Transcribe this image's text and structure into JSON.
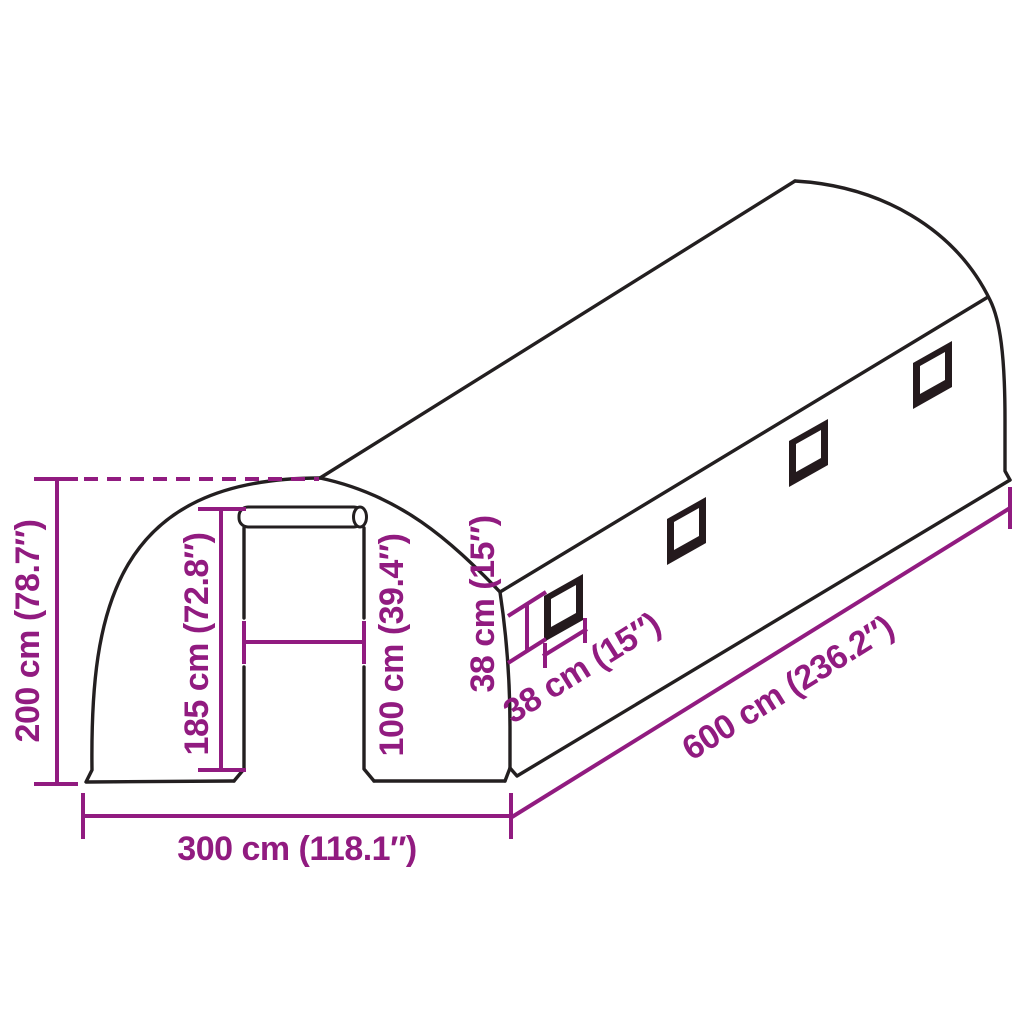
{
  "diagram": {
    "subject": "tunnel-greenhouse-dimension-diagram",
    "window_count": 4,
    "colors": {
      "dimension_accent": "#911B80",
      "outline": "#231F20",
      "window_frame": "#241A1D",
      "background": "#FFFFFF"
    },
    "labels": {
      "total_height": "200 cm (78.7″)",
      "door_height": "185 cm (72.8″)",
      "door_width": "100 cm (39.4″)",
      "window_height": "38 cm (15″)",
      "window_width": "38 cm (15″)",
      "length": "600 cm (236.2″)",
      "width": "300 cm (118.1″)"
    }
  }
}
